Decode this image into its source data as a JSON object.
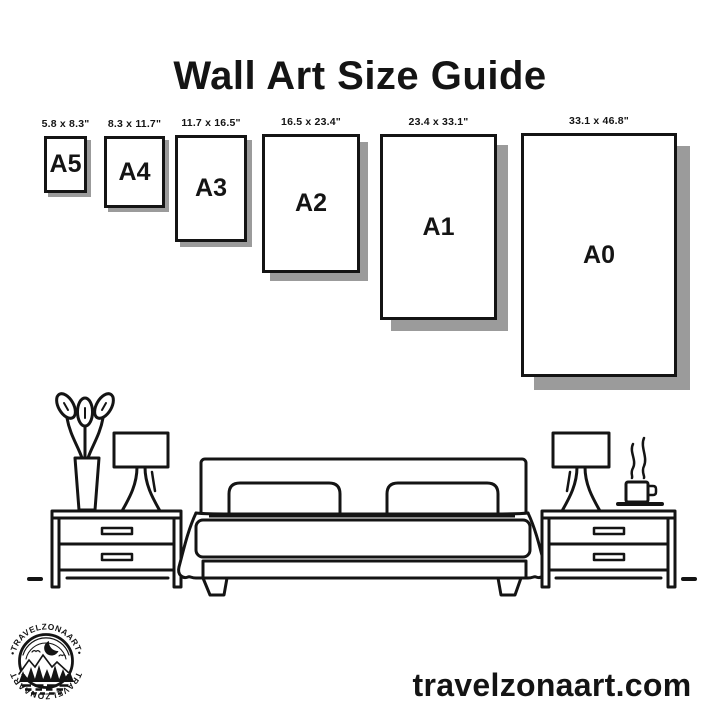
{
  "title": "Wall Art Size Guide",
  "papers": [
    {
      "name": "A5",
      "label": "5.8 x 8.3\"",
      "x": 44,
      "top": 136,
      "width": 43,
      "height": 57,
      "shadow": 4
    },
    {
      "name": "A4",
      "label": "8.3 x 11.7\"",
      "x": 104,
      "top": 136,
      "width": 61,
      "height": 72,
      "shadow": 4
    },
    {
      "name": "A3",
      "label": "11.7 x 16.5\"",
      "x": 175,
      "top": 135,
      "width": 72,
      "height": 107,
      "shadow": 5
    },
    {
      "name": "A2",
      "label": "16.5 x 23.4\"",
      "x": 262,
      "top": 134,
      "width": 98,
      "height": 139,
      "shadow": 8
    },
    {
      "name": "A1",
      "label": "23.4 x 33.1\"",
      "x": 380,
      "top": 134,
      "width": 117,
      "height": 186,
      "shadow": 11
    },
    {
      "name": "A0",
      "label": "33.1 x 46.8\"",
      "x": 521,
      "top": 133,
      "width": 156,
      "height": 244,
      "shadow": 13
    }
  ],
  "logo": {
    "top_text": "•TRAVELZONAART•",
    "bottom_text": "TRAVELZONAART"
  },
  "footer": {
    "website": "travelzonaart.com"
  },
  "colors": {
    "ink": "#141414",
    "shadow": "#9b9b9b",
    "background": "#ffffff"
  }
}
